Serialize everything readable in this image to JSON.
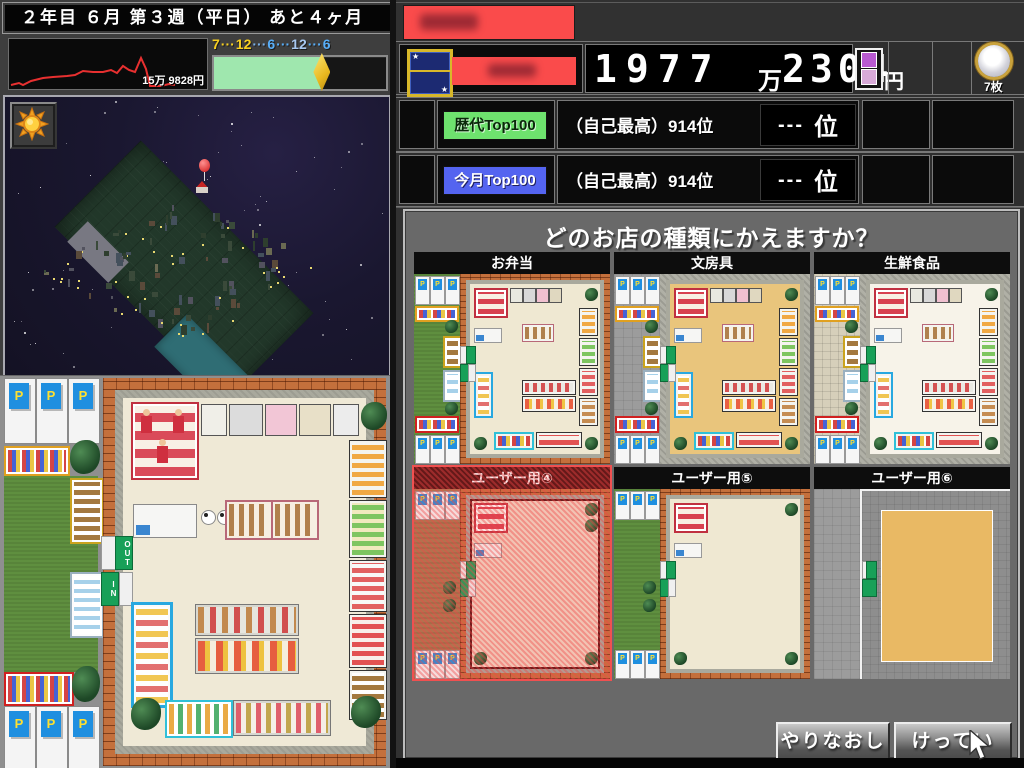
{
  "colors": {
    "money_banner_red": "#fa4b4b",
    "badge_green": "#6ee26e",
    "badge_blue": "#5464f0",
    "progress_green": "#9fe7ae",
    "selected_tile_red": "#f05050",
    "chart_line_red": "#e83030"
  },
  "left": {
    "date_header": "２年目 ６月 第３週（平日） あと４ヶ月",
    "sales_chart": {
      "type": "line",
      "label": "15万 9828円",
      "line_color": "#e83030",
      "points": [
        [
          2,
          46
        ],
        [
          10,
          44
        ],
        [
          14,
          46
        ],
        [
          22,
          42
        ],
        [
          34,
          39
        ],
        [
          44,
          38
        ],
        [
          58,
          37
        ],
        [
          66,
          36
        ],
        [
          74,
          32
        ],
        [
          84,
          33
        ],
        [
          94,
          33
        ],
        [
          102,
          31
        ],
        [
          108,
          34
        ],
        [
          114,
          27
        ],
        [
          120,
          31
        ],
        [
          126,
          33
        ],
        [
          132,
          19
        ],
        [
          137,
          30
        ],
        [
          141,
          47
        ],
        [
          152,
          47
        ],
        [
          160,
          45
        ],
        [
          166,
          46
        ]
      ]
    },
    "clock": {
      "segments": [
        {
          "t": "7",
          "c": "#f8d020"
        },
        {
          "t": "···",
          "c": "#f8d020"
        },
        {
          "t": "12",
          "c": "#f8d020"
        },
        {
          "t": "···",
          "c": "#7ab0e8"
        },
        {
          "t": "6",
          "c": "#58aef8"
        },
        {
          "t": "···",
          "c": "#58aef8"
        },
        {
          "t": "12",
          "c": "#a8c8f0"
        },
        {
          "t": "···",
          "c": "#58aef8"
        },
        {
          "t": "6",
          "c": "#58aef8"
        }
      ],
      "progress_pct": 63
    },
    "minimap": {
      "marker": "red-balloon",
      "sun_icon": "sun"
    }
  },
  "right": {
    "money": {
      "man_digits": "1977",
      "man_unit": "万",
      "yen_digits": "2304",
      "yen_unit": "円",
      "full_value": "1977万2304円"
    },
    "coin_count": "7枚",
    "rankings": [
      {
        "badge": "歴代Top100",
        "self_best": "（自己最高）914位",
        "rank_dashes": "---",
        "rank_unit": "位"
      },
      {
        "badge": "今月Top100",
        "self_best": "（自己最高）914位",
        "rank_dashes": "---",
        "rank_unit": "位"
      }
    ]
  },
  "store_map": {
    "parking_label": "P",
    "out_label": "OUT",
    "in_label": "IN"
  },
  "dialog": {
    "title": "どのお店の種類にかえますか？",
    "tiles": [
      {
        "label": "お弁当",
        "variant": "bento",
        "ground": "grass",
        "floor": "#efe8d2",
        "wall": "brick",
        "contents": "full",
        "selected": false
      },
      {
        "label": "文房具",
        "variant": "stationery",
        "ground": "concrete",
        "floor": "#e9c57c",
        "wall": "gray",
        "contents": "full",
        "selected": false
      },
      {
        "label": "生鮮食品",
        "variant": "fresh",
        "ground": "pavers",
        "floor": "#f7f3e9",
        "wall": "gray",
        "contents": "full",
        "selected": false
      },
      {
        "label": "ユーザー用④",
        "variant": "user4",
        "ground": "dirt",
        "floor": "#f2d9c6",
        "wall": "brick",
        "contents": "sparse",
        "selected": true
      },
      {
        "label": "ユーザー用⑤",
        "variant": "user5",
        "ground": "grass",
        "floor": "#efe8d2",
        "wall": "brick",
        "contents": "sparse",
        "selected": false
      },
      {
        "label": "ユーザー用⑥",
        "variant": "user6",
        "ground": "concrete-full",
        "floor": "#e9b964",
        "wall": "white",
        "contents": "empty",
        "selected": false
      }
    ],
    "buttons": [
      {
        "label": "やりなおし"
      },
      {
        "label": "けってい"
      }
    ]
  }
}
